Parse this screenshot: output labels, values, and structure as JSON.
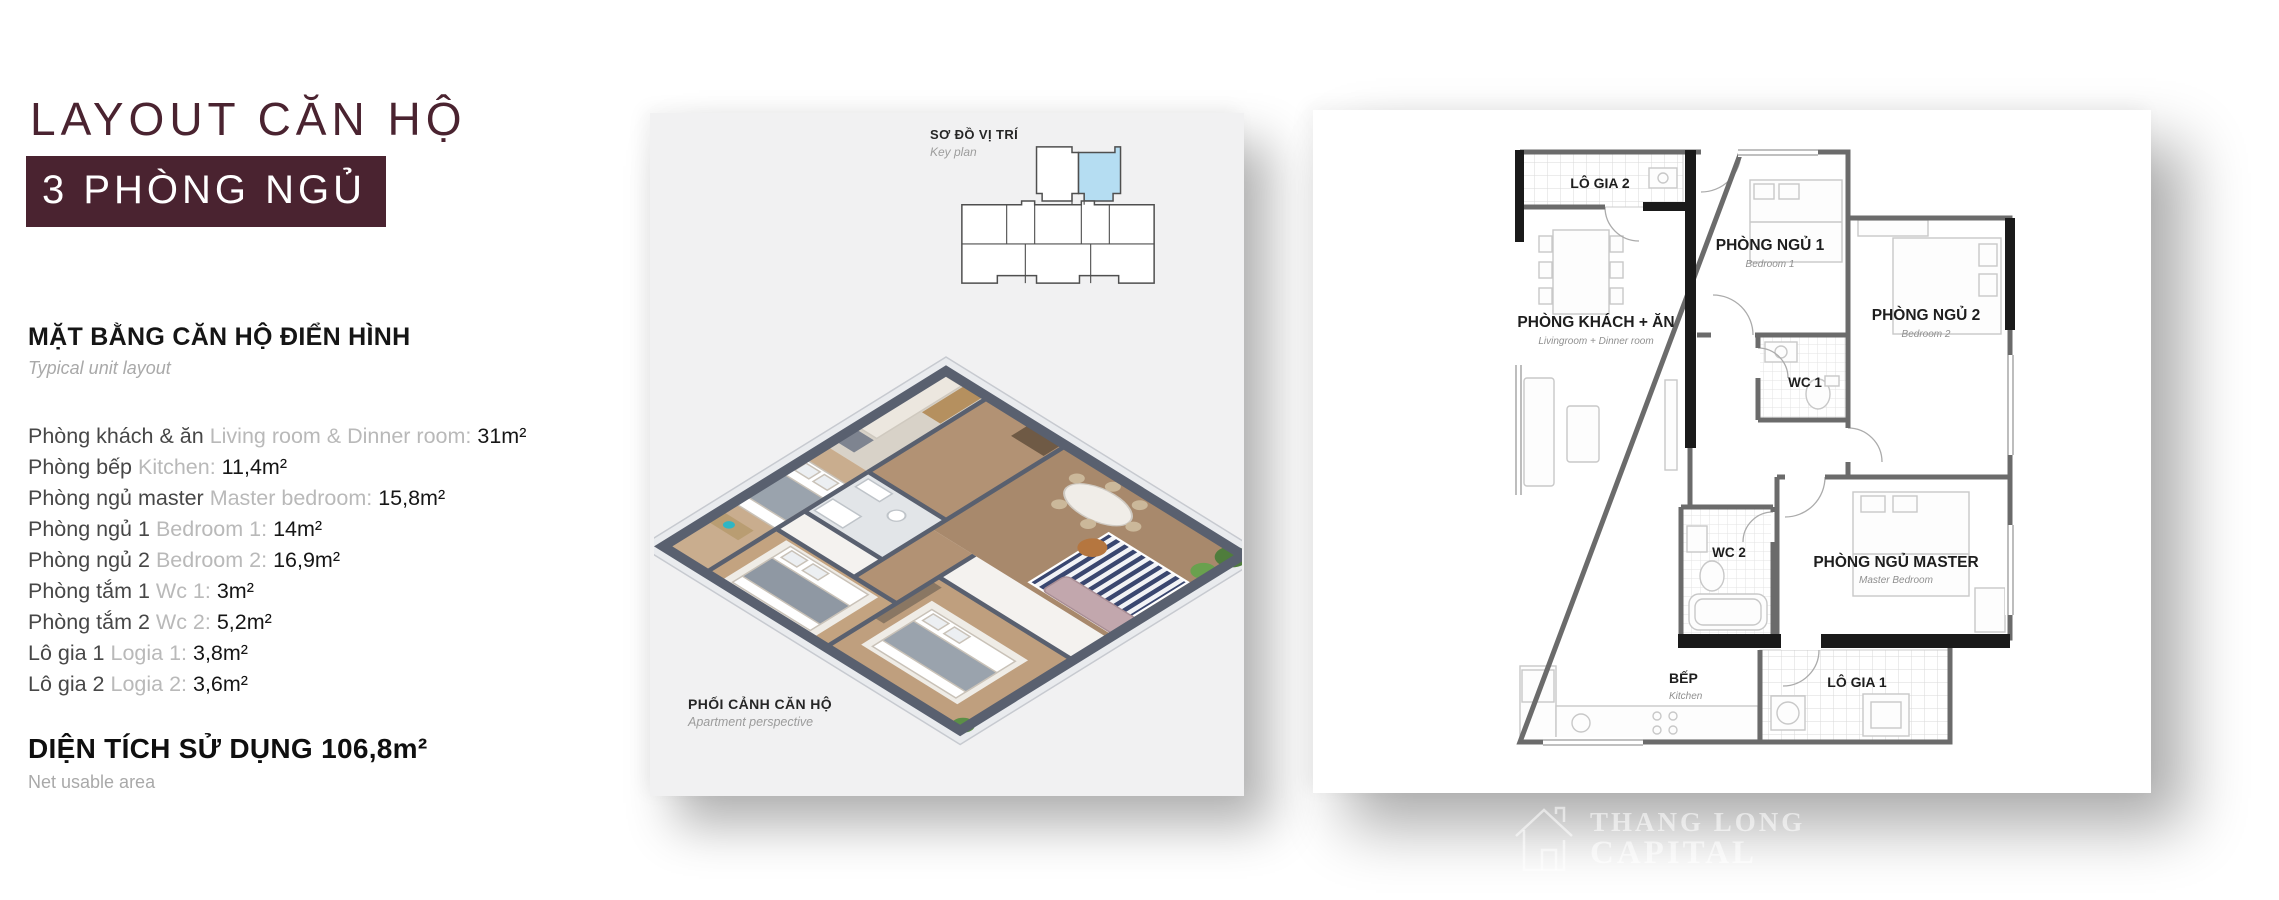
{
  "header": {
    "title": "LAYOUT CĂN HỘ",
    "subtitle": "3 PHÒNG NGỦ",
    "accent_color": "#4a2330"
  },
  "unit_info": {
    "heading_vn": "MẶT BẰNG CĂN HỘ ĐIỂN HÌNH",
    "heading_en": "Typical  unit layout",
    "rooms": [
      {
        "vn": "Phòng khách & ăn",
        "en": "Living room & Dinner room:",
        "area": "31m²"
      },
      {
        "vn": "Phòng bếp",
        "en": "Kitchen:",
        "area": "11,4m²"
      },
      {
        "vn": "Phòng ngủ master",
        "en": "Master bedroom:",
        "area": "15,8m²"
      },
      {
        "vn": "Phòng ngủ 1",
        "en": "Bedroom 1:",
        "area": "14m²"
      },
      {
        "vn": "Phòng ngủ 2",
        "en": "Bedroom 2:",
        "area": "16,9m²"
      },
      {
        "vn": "Phòng tắm 1",
        "en": "Wc 1:",
        "area": "3m²"
      },
      {
        "vn": "Phòng tắm 2",
        "en": "Wc 2:",
        "area": "5,2m²"
      },
      {
        "vn": "Lô gia 1",
        "en": "Logia 1:",
        "area": "3,8m²"
      },
      {
        "vn": "Lô gia 2",
        "en": "Logia 2:",
        "area": "3,6m²"
      }
    ],
    "total_vn": "DIỆN TÍCH SỬ DỤNG",
    "total_area": "106,8m²",
    "total_en": "Net usable area"
  },
  "perspective_card": {
    "keyplan_title": "SƠ ĐỒ VỊ TRÍ",
    "keyplan_sub": "Key plan",
    "keyplan_highlight": "#b5ddf2",
    "persp_title": "PHỐI CẢNH CĂN HỘ",
    "persp_sub": "Apartment perspective"
  },
  "floorplan": {
    "logia2": {
      "vn": "LÔ GIA 2"
    },
    "bedroom1": {
      "vn": "PHÒNG NGỦ 1",
      "en": "Bedroom 1"
    },
    "bedroom2": {
      "vn": "PHÒNG NGỦ 2",
      "en": "Bedroom 2"
    },
    "living": {
      "vn": "PHÒNG KHÁCH + ĂN",
      "en": "Livingroom + Dinner room"
    },
    "wc1": {
      "vn": "WC 1"
    },
    "wc2": {
      "vn": "WC 2"
    },
    "master": {
      "vn": "PHÒNG NGỦ MASTER",
      "en": "Master Bedroom"
    },
    "kitchen": {
      "vn": "BẾP",
      "en": "Kitchen"
    },
    "logia1": {
      "vn": "LÔ GIA 1"
    }
  },
  "watermark": {
    "line1": "THANG LONG",
    "line2": "CAPITAL"
  }
}
